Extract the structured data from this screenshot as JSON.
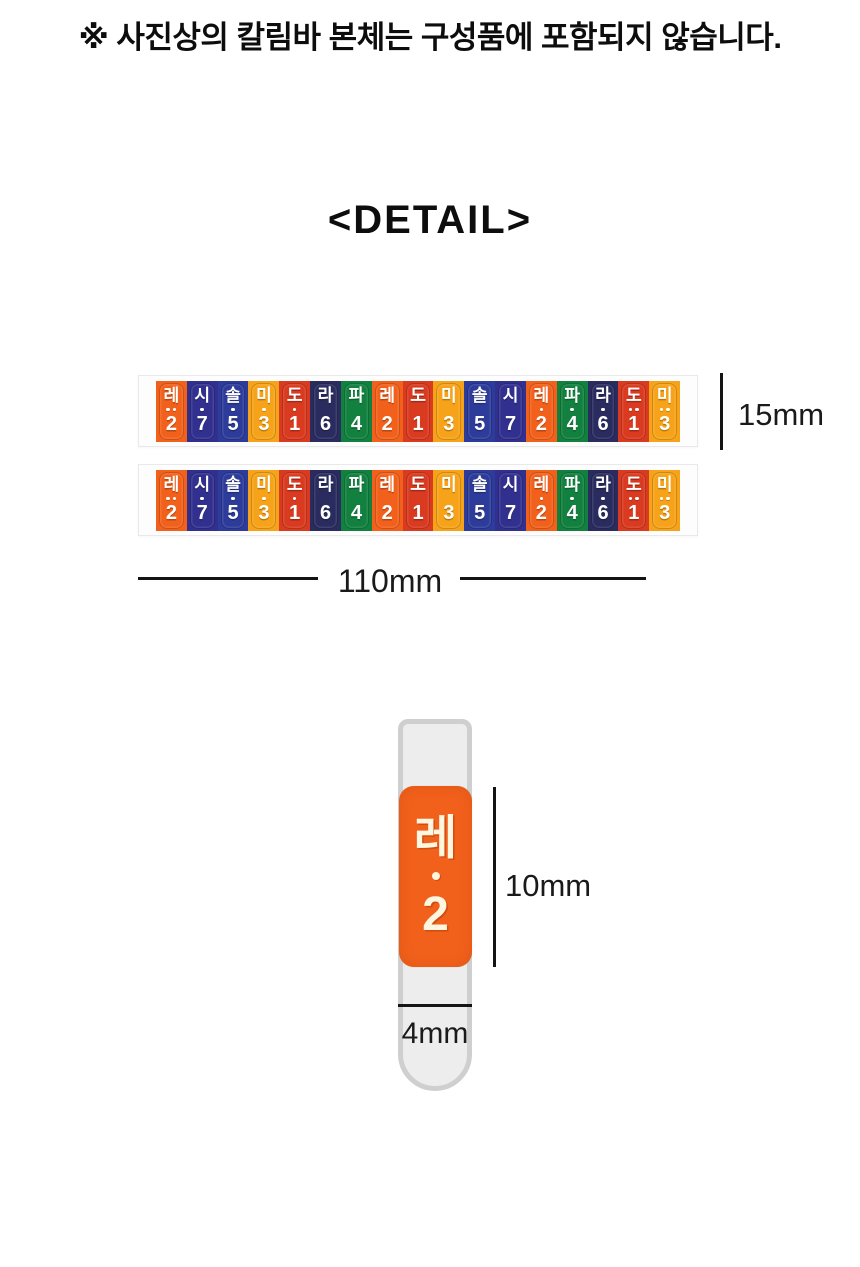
{
  "page": {
    "background": "#ffffff",
    "notice": "※ 사진상의 칼림바 본체는 구성품에 포함되지 않습니다.",
    "heading": "<DETAIL>"
  },
  "note_colors": {
    "do": "#d93a20",
    "re": "#f2611c",
    "mi": "#f6a31a",
    "fa": "#12813f",
    "sol": "#2d3c9b",
    "la": "#2a2c5f",
    "si": "#32308f"
  },
  "sticker_strip": {
    "strip_count": 2,
    "tabs": [
      {
        "syllable": "레",
        "number": "2",
        "octave_dots": 2,
        "color_key": "re"
      },
      {
        "syllable": "시",
        "number": "7",
        "octave_dots": 1,
        "color_key": "si"
      },
      {
        "syllable": "솔",
        "number": "5",
        "octave_dots": 1,
        "color_key": "sol"
      },
      {
        "syllable": "미",
        "number": "3",
        "octave_dots": 1,
        "color_key": "mi"
      },
      {
        "syllable": "도",
        "number": "1",
        "octave_dots": 1,
        "color_key": "do"
      },
      {
        "syllable": "라",
        "number": "6",
        "octave_dots": 0,
        "color_key": "la"
      },
      {
        "syllable": "파",
        "number": "4",
        "octave_dots": 0,
        "color_key": "fa"
      },
      {
        "syllable": "레",
        "number": "2",
        "octave_dots": 0,
        "color_key": "re"
      },
      {
        "syllable": "도",
        "number": "1",
        "octave_dots": 0,
        "color_key": "do"
      },
      {
        "syllable": "미",
        "number": "3",
        "octave_dots": 0,
        "color_key": "mi"
      },
      {
        "syllable": "솔",
        "number": "5",
        "octave_dots": 0,
        "color_key": "sol"
      },
      {
        "syllable": "시",
        "number": "7",
        "octave_dots": 0,
        "color_key": "si"
      },
      {
        "syllable": "레",
        "number": "2",
        "octave_dots": 1,
        "color_key": "re"
      },
      {
        "syllable": "파",
        "number": "4",
        "octave_dots": 1,
        "color_key": "fa"
      },
      {
        "syllable": "라",
        "number": "6",
        "octave_dots": 1,
        "color_key": "la"
      },
      {
        "syllable": "도",
        "number": "1",
        "octave_dots": 2,
        "color_key": "do"
      },
      {
        "syllable": "미",
        "number": "3",
        "octave_dots": 2,
        "color_key": "mi"
      }
    ]
  },
  "dimensions": {
    "strip_height": "15mm",
    "strip_length": "110mm",
    "sticker_height": "10mm",
    "sticker_width": "4mm"
  },
  "single_sticker": {
    "syllable": "레",
    "number": "2",
    "octave_dots": 1,
    "color_key": "re"
  }
}
